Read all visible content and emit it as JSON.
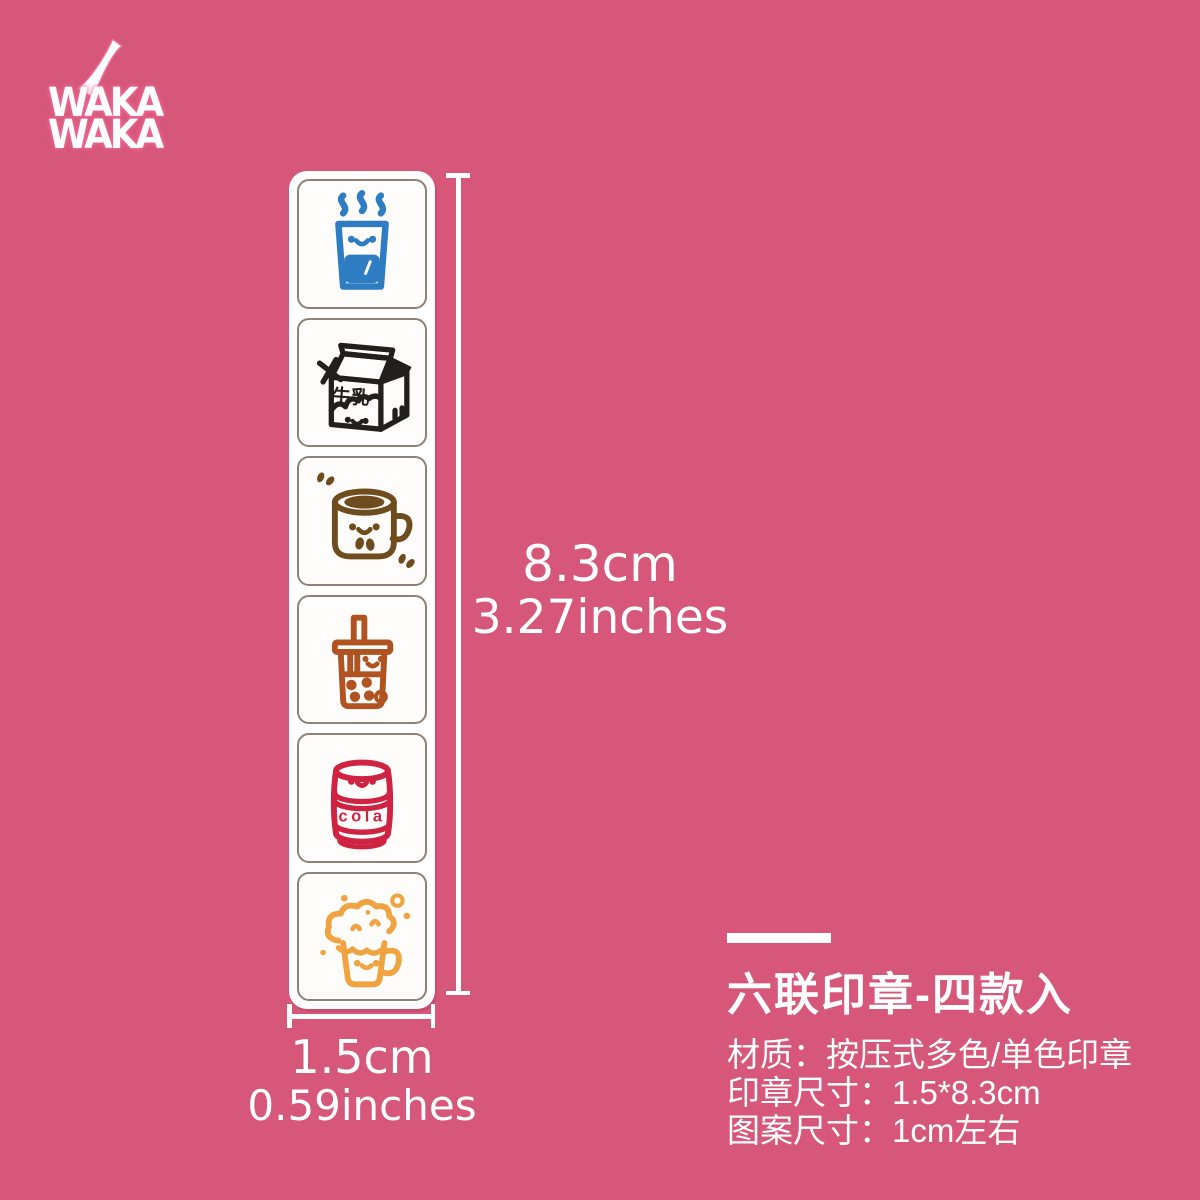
{
  "background_color": "#d6577a",
  "logo": {
    "line1": "WAKA",
    "line2": "WAKA",
    "color": "#ffffff",
    "glow_color": "#f4719c"
  },
  "strip": {
    "cell_border_color": "#8e8175",
    "stamps": [
      {
        "name": "hot-water-glass",
        "color": "#2e7dc3"
      },
      {
        "name": "milk-carton",
        "color": "#221f1c",
        "label": "牛乳"
      },
      {
        "name": "coffee-mug",
        "color": "#6f4c1e"
      },
      {
        "name": "bubble-tea",
        "color": "#b05320"
      },
      {
        "name": "cola-can",
        "color": "#d02342",
        "label": "cola"
      },
      {
        "name": "beer-mug",
        "color": "#f0a441"
      }
    ]
  },
  "dimensions": {
    "height": {
      "cm": "8.3cm",
      "inches": "3.27inches"
    },
    "width": {
      "cm": "1.5cm",
      "inches": "0.59inches"
    }
  },
  "product_info": {
    "title": "六联印章-四款入",
    "material": "材质：按压式多色/单色印章",
    "stamp_size": "印章尺寸：1.5*8.3cm",
    "pattern_size": "图案尺寸：1cm左右"
  }
}
